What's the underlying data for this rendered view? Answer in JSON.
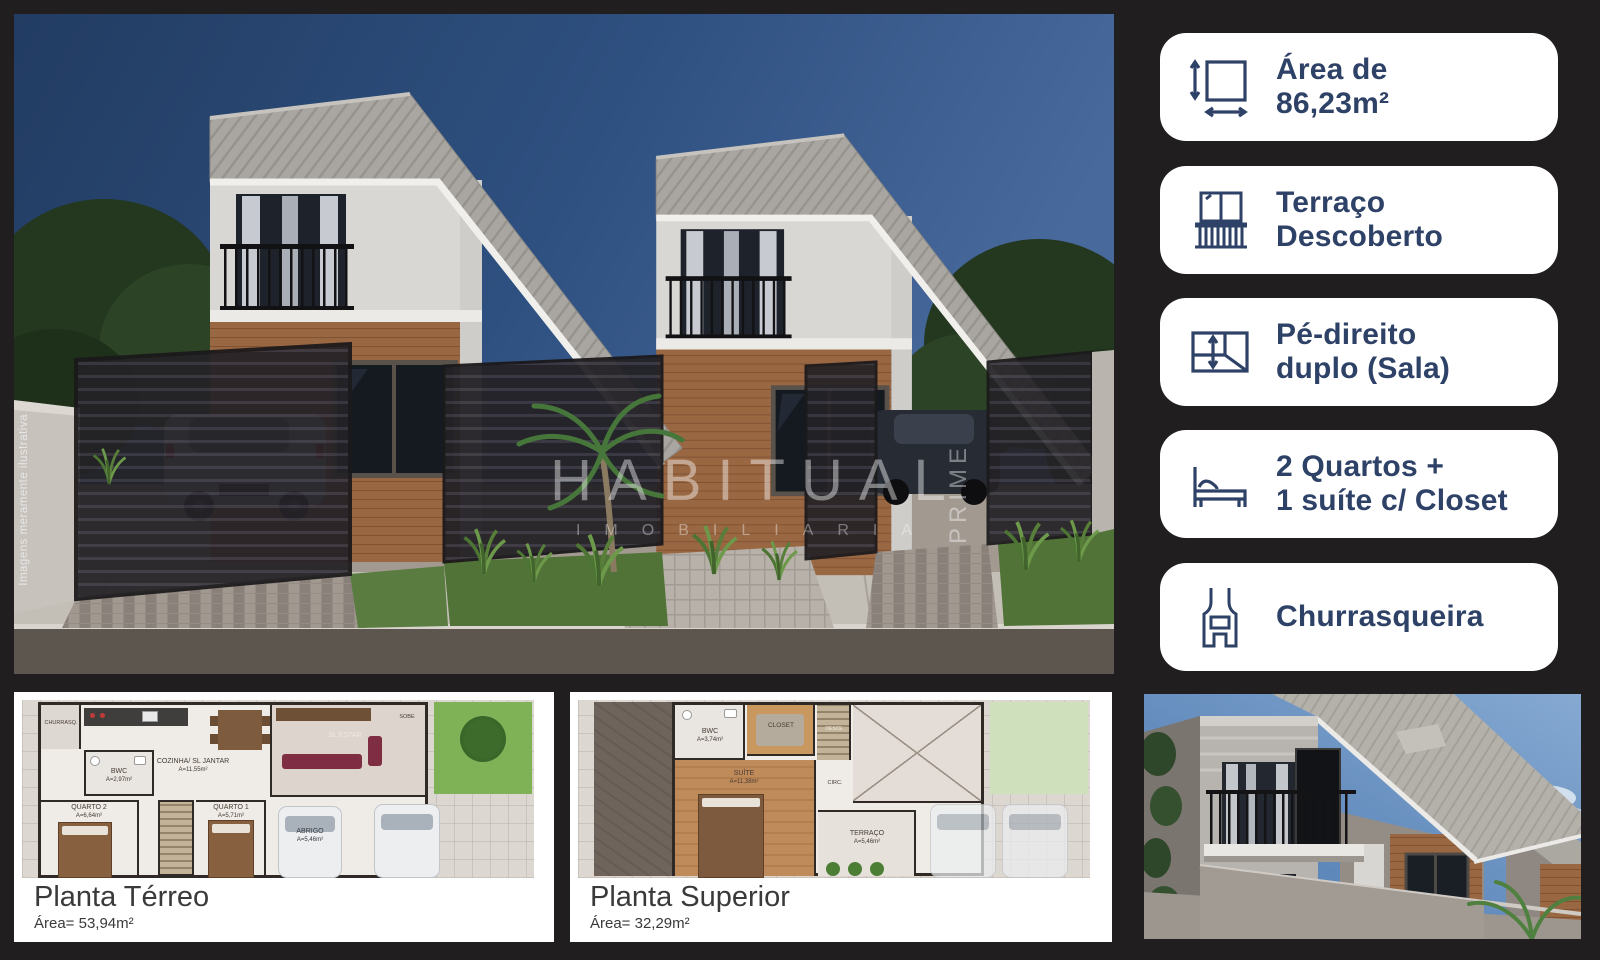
{
  "colors": {
    "background": "#211e1f",
    "badge_bg": "#ffffff",
    "accent_navy": "#2e4166"
  },
  "main_render": {
    "watermark": {
      "line1": "HABITUAL",
      "line2": "IMOBILIARIA",
      "vertical": "PRIME"
    },
    "disclaimer": "Imagens meramente ilustrativa"
  },
  "sidebar": {
    "badges": [
      {
        "icon": "area-dimensions-icon",
        "line1": "Área de",
        "line2": "86,23m²"
      },
      {
        "icon": "balcony-icon",
        "line1": "Terraço",
        "line2": "Descoberto"
      },
      {
        "icon": "ceiling-height-icon",
        "line1": "Pé-direito",
        "line2": "duplo (Sala)"
      },
      {
        "icon": "bed-icon",
        "line1": "2 Quartos +",
        "line2": "1 suíte c/ Closet"
      },
      {
        "icon": "barbecue-icon",
        "line1": "Churrasqueira",
        "line2": ""
      }
    ]
  },
  "floor_plans": {
    "terreo": {
      "title": "Planta Térreo",
      "area": "Área= 53,94m²",
      "rooms": [
        {
          "label": "CHURRASQ."
        },
        {
          "label": "COZINHA/ SL JANTAR",
          "area": "A=11,55m²"
        },
        {
          "label": "SL ESTAR"
        },
        {
          "label": "SOBE"
        },
        {
          "label": "BWC",
          "area": "A=2,97m²"
        },
        {
          "label": "QUARTO 2",
          "area": "A=6,64m²"
        },
        {
          "label": "QUARTO 1",
          "area": "A=5,71m²"
        },
        {
          "label": "ABRIGO",
          "area": "A=5,46m²"
        }
      ]
    },
    "superior": {
      "title": "Planta Superior",
      "area": "Área= 32,29m²",
      "rooms": [
        {
          "label": "BWC",
          "area": "A=3,74m²"
        },
        {
          "label": "CLOSET"
        },
        {
          "label": "DESCE"
        },
        {
          "label": "SUÍTE",
          "area": "A=11,38m²"
        },
        {
          "label": "CIRC."
        },
        {
          "label": "TERRAÇO",
          "area": "A=5,46m²"
        }
      ]
    }
  }
}
